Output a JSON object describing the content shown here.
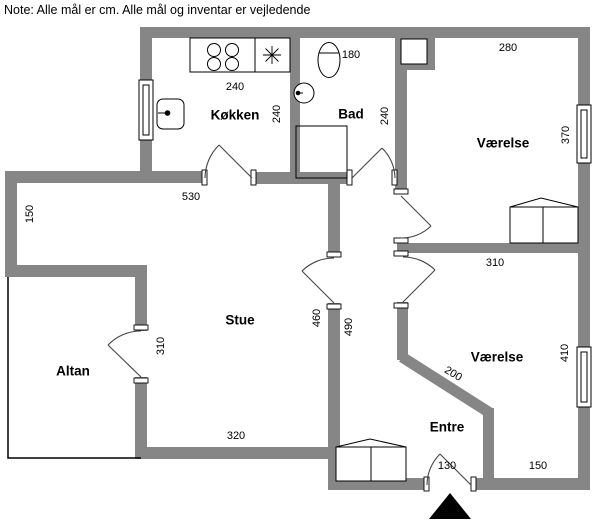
{
  "note": "Note: Alle mål er cm. Alle mål og inventar er vejledende",
  "colors": {
    "wall": "#868686",
    "line": "#000000",
    "floor": "#ffffff",
    "door_arc": "#444444"
  },
  "room_labels": [
    {
      "id": "koekken",
      "name": "Køkken",
      "x": 235,
      "y": 115,
      "rot": 0
    },
    {
      "id": "bad",
      "name": "Bad",
      "x": 351,
      "y": 114,
      "rot": 0
    },
    {
      "id": "vaerelse-top",
      "name": "Værelse",
      "x": 503,
      "y": 143,
      "rot": 0
    },
    {
      "id": "stue",
      "name": "Stue",
      "x": 240,
      "y": 320,
      "rot": 0
    },
    {
      "id": "altan",
      "name": "Altan",
      "x": 73,
      "y": 371,
      "rot": 0
    },
    {
      "id": "vaerelse-bottom",
      "name": "Værelse",
      "x": 497,
      "y": 357,
      "rot": 0
    },
    {
      "id": "entre",
      "name": "Entre",
      "x": 447,
      "y": 427,
      "rot": 0
    }
  ],
  "dimension_labels": [
    {
      "id": "koekken-width",
      "value": "240",
      "x": 235,
      "y": 87,
      "rot": 0
    },
    {
      "id": "koekken-depth",
      "value": "240",
      "x": 277,
      "y": 114,
      "rot": -90
    },
    {
      "id": "bad-width",
      "value": "180",
      "x": 351,
      "y": 55,
      "rot": 0
    },
    {
      "id": "bad-depth",
      "value": "240",
      "x": 385,
      "y": 116,
      "rot": -90
    },
    {
      "id": "vaerelse-top-width",
      "value": "280",
      "x": 508,
      "y": 48,
      "rot": 0
    },
    {
      "id": "vaerelse-top-depth",
      "value": "370",
      "x": 566,
      "y": 135,
      "rot": -90
    },
    {
      "id": "stue-top-width",
      "value": "530",
      "x": 191,
      "y": 197,
      "rot": 0
    },
    {
      "id": "nook-depth",
      "value": "150",
      "x": 30,
      "y": 214,
      "rot": -90
    },
    {
      "id": "altan-door",
      "value": "310",
      "x": 161,
      "y": 346,
      "rot": -90
    },
    {
      "id": "divider-width",
      "value": "310",
      "x": 495,
      "y": 263,
      "rot": 0
    },
    {
      "id": "stue-height",
      "value": "460",
      "x": 317,
      "y": 318,
      "rot": -90
    },
    {
      "id": "hall-height",
      "value": "490",
      "x": 349,
      "y": 327,
      "rot": -90
    },
    {
      "id": "vaerelse-bot-depth",
      "value": "410",
      "x": 565,
      "y": 353,
      "rot": -90
    },
    {
      "id": "diagonal-wall",
      "value": "200",
      "x": 453,
      "y": 374,
      "rot": 31
    },
    {
      "id": "stue-bottom-width",
      "value": "320",
      "x": 236,
      "y": 436,
      "rot": 0
    },
    {
      "id": "entrance-width",
      "value": "130",
      "x": 447,
      "y": 466,
      "rot": 0
    },
    {
      "id": "bottom-right-width",
      "value": "150",
      "x": 538,
      "y": 466,
      "rot": 0
    }
  ]
}
